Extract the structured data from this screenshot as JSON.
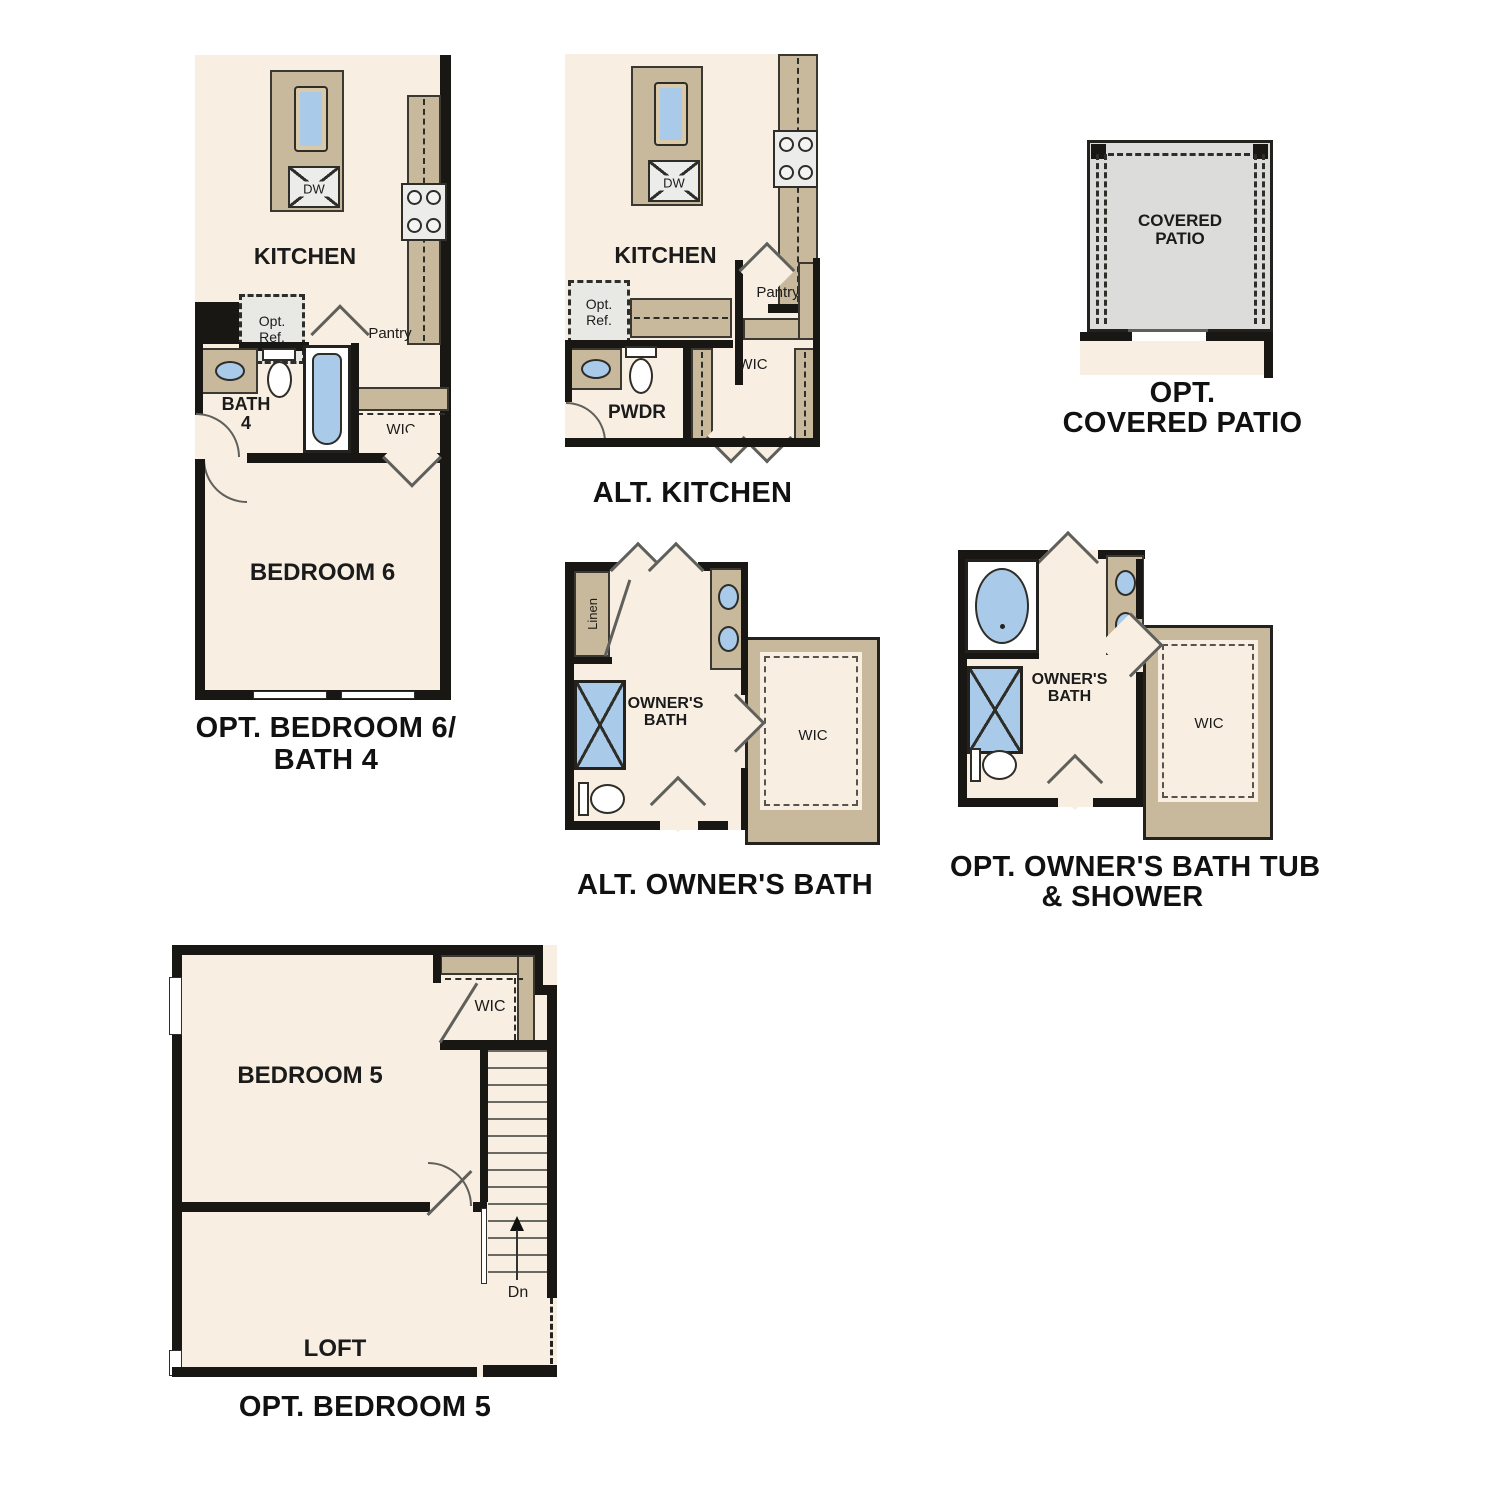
{
  "document": {
    "background": "#ffffff",
    "type_note": "floor plan options sheet"
  },
  "colors": {
    "wall": "#181714",
    "floor": "#f8efe2",
    "counter": "#c9b99c",
    "fixture_blue": "#a9cbe9",
    "gray_box": "#ececea",
    "patio_gray": "#dcdcda",
    "text": "#1b1b1b"
  },
  "plan_bedroom6": {
    "kitchen_label": "KITCHEN",
    "dw_label": "DW",
    "opt_ref_label": "Opt. Ref.",
    "pantry_label": "Pantry",
    "bath_label": "BATH 4",
    "wic_label": "WIC",
    "bedroom_label": "BEDROOM 6",
    "caption_line1": "OPT. BEDROOM 6/",
    "caption_line2": "BATH 4"
  },
  "plan_alt_kitchen": {
    "kitchen_label": "KITCHEN",
    "dw_label": "DW",
    "opt_ref_label": "Opt. Ref.",
    "pantry_label": "Pantry",
    "pwdr_label": "PWDR",
    "wic_label": "WIC",
    "caption": "ALT. KITCHEN"
  },
  "plan_covered_patio": {
    "room_label": "COVERED PATIO",
    "caption_line1": "OPT.",
    "caption_line2": "COVERED PATIO"
  },
  "plan_alt_owners_bath": {
    "linen_label": "Linen",
    "room_label": "OWNER'S BATH",
    "wic_label": "WIC",
    "caption": "ALT. OWNER'S BATH"
  },
  "plan_opt_owners_bath": {
    "room_label": "OWNER'S BATH",
    "wic_label": "WIC",
    "caption_line1": "OPT. OWNER'S BATH TUB",
    "caption_line2": "& SHOWER"
  },
  "plan_opt_bedroom5": {
    "bedroom_label": "BEDROOM 5",
    "wic_label": "WIC",
    "loft_label": "LOFT",
    "dn_label": "Dn",
    "caption": "OPT. BEDROOM 5"
  }
}
